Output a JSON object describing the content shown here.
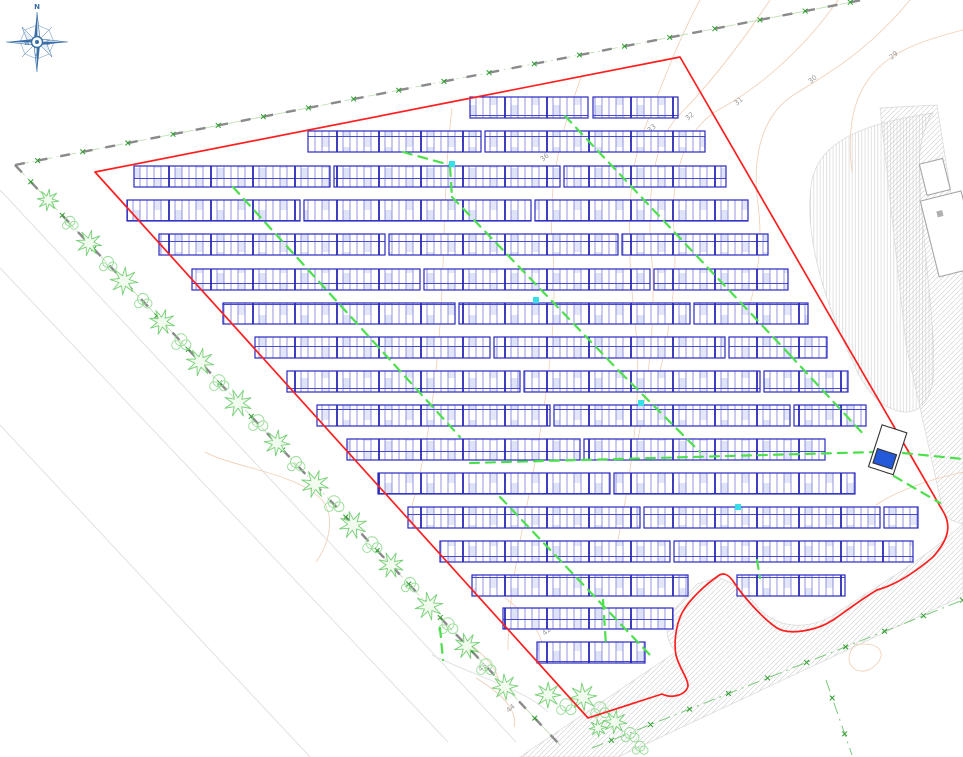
{
  "compass": {
    "n": "N",
    "s": "S",
    "e": "E",
    "w": "W"
  },
  "colors": {
    "boundary_red": "#ff1f1f",
    "panel_blue": "#2a2ac2",
    "panel_grid": "#6a6ad8",
    "panel_fill": "#dfe3f8",
    "cable_green": "#4ce04c",
    "fence_x_green": "#2f9e2f",
    "fence_gray": "#8a8a8a",
    "tree_green": "#76cf76",
    "contour_tan": "#f0cdb2",
    "label_gray": "#9a9a9a",
    "hatch_gray": "#c8c8c8",
    "marker_cyan": "#35e0e8",
    "transformer_blue": "#2459d9",
    "compass_blue": "#3a6ea5"
  },
  "plan": {
    "boundary_path": "M95,172 L680,57 L944,513 C951,526 949,539 933,557 C913,574 895,585 877,590 C860,600 845,612 833,620 C818,630 790,636 777,628 C762,618 742,595 733,581 C728,574 723,572 718,576 C708,583 690,598 682,613 C675,627 674,645 676,655 C679,668 688,678 688,686 C686,695 672,699 662,694 L588,718 Z",
    "panel_row_height": 21,
    "panel_rows": [
      {
        "y": 97,
        "segments": [
          [
            470,
            588
          ],
          [
            593,
            678
          ]
        ]
      },
      {
        "y": 131,
        "segments": [
          [
            308,
            481
          ],
          [
            485,
            705
          ]
        ]
      },
      {
        "y": 166,
        "segments": [
          [
            134,
            330
          ],
          [
            334,
            560
          ],
          [
            564,
            726
          ]
        ]
      },
      {
        "y": 200,
        "segments": [
          [
            127,
            300
          ],
          [
            304,
            531
          ],
          [
            535,
            748
          ]
        ]
      },
      {
        "y": 234,
        "segments": [
          [
            159,
            385
          ],
          [
            389,
            618
          ],
          [
            622,
            768
          ]
        ]
      },
      {
        "y": 269,
        "segments": [
          [
            192,
            420
          ],
          [
            424,
            650
          ],
          [
            654,
            788
          ]
        ]
      },
      {
        "y": 303,
        "segments": [
          [
            223,
            455
          ],
          [
            459,
            690
          ],
          [
            694,
            808
          ]
        ]
      },
      {
        "y": 337,
        "segments": [
          [
            255,
            490
          ],
          [
            494,
            725
          ],
          [
            729,
            827
          ]
        ]
      },
      {
        "y": 371,
        "segments": [
          [
            287,
            520
          ],
          [
            524,
            760
          ],
          [
            764,
            848
          ]
        ]
      },
      {
        "y": 405,
        "segments": [
          [
            317,
            550
          ],
          [
            554,
            790
          ],
          [
            794,
            866
          ]
        ]
      },
      {
        "y": 439,
        "segments": [
          [
            347,
            580
          ],
          [
            584,
            825
          ]
        ]
      },
      {
        "y": 473,
        "segments": [
          [
            378,
            610
          ],
          [
            614,
            855
          ]
        ]
      },
      {
        "y": 507,
        "segments": [
          [
            408,
            640
          ],
          [
            644,
            880
          ],
          [
            884,
            918
          ]
        ]
      },
      {
        "y": 541,
        "segments": [
          [
            440,
            670
          ],
          [
            674,
            913
          ]
        ]
      },
      {
        "y": 575,
        "segments": [
          [
            472,
            688
          ],
          [
            737,
            845
          ]
        ]
      },
      {
        "y": 608,
        "segments": [
          [
            503,
            673
          ]
        ]
      },
      {
        "y": 642,
        "segments": [
          [
            537,
            645
          ]
        ]
      }
    ],
    "cables": [
      [
        233,
        187,
        460,
        437
      ],
      [
        403,
        152,
        450,
        165
      ],
      [
        450,
        167,
        452,
        197
      ],
      [
        452,
        197,
        620,
        372
      ],
      [
        620,
        372,
        700,
        452
      ],
      [
        565,
        116,
        790,
        355
      ],
      [
        790,
        355,
        866,
        437
      ],
      [
        500,
        497,
        650,
        655
      ],
      [
        470,
        463,
        876,
        452
      ],
      [
        903,
        453,
        963,
        459
      ],
      [
        880,
        468,
        940,
        503
      ],
      [
        603,
        600,
        606,
        645
      ],
      [
        440,
        628,
        443,
        660
      ],
      [
        757,
        560,
        760,
        578
      ]
    ],
    "cable_markers": [
      [
        452,
        164
      ],
      [
        536,
        300
      ],
      [
        641,
        403
      ],
      [
        738,
        507
      ]
    ],
    "fences": [
      {
        "x1": 15,
        "y1": 165,
        "x2": 862,
        "y2": 0,
        "step": 46,
        "style": "gray"
      },
      {
        "x1": 15,
        "y1": 165,
        "x2": 560,
        "y2": 745,
        "step": 46,
        "style": "gray"
      },
      {
        "x1": 592,
        "y1": 748,
        "x2": 963,
        "y2": 600,
        "step": 42,
        "style": "green"
      },
      {
        "x1": 826,
        "y1": 680,
        "x2": 852,
        "y2": 755,
        "step": 38,
        "style": "green"
      }
    ],
    "curbs": [
      "M0,190 L516,742",
      "M0,268 L448,742",
      "M0,425 L310,757",
      "M432,655 C480,678 525,690 548,712"
    ],
    "roads": [
      {
        "name": "verge-blob",
        "hatch": "vertical",
        "path": "M933,113 C858,124 820,143 812,180 C803,230 822,296 852,360 C868,398 886,410 904,412 C920,413 930,400 933,380 C938,330 916,205 920,152 C921,137 927,121 933,113 Z"
      },
      {
        "name": "road-east",
        "hatch": "diag",
        "path": "M880,108 L937,105 L963,270 L963,524 C950,521 946,517 943,511 L906,345 Z"
      },
      {
        "name": "road-south",
        "hatch": "diag",
        "path": "M963,524 L963,596 L618,757 L520,757 L676,652 C666,642 664,626 672,612 L697,584 L718,577 L742,588 L760,610 C782,630 812,630 838,612 L900,572 C925,556 945,540 963,524 Z"
      }
    ],
    "contours": [
      "M963,30 C915,42 885,55 868,80 C850,105 848,140 852,172",
      "M910,0 C865,55 820,78 792,96 C760,118 752,160 758,205 C763,240 758,280 748,310",
      "M838,0 C800,55 752,92 718,110 C684,130 670,178 674,232 C678,275 670,330 658,380",
      "M770,0 C738,48 706,88 680,114 C652,142 646,200 652,262 C656,318 648,390 636,450",
      "M700,0 C678,40 660,90 644,130 C624,182 628,262 636,332 C642,395 632,470 618,540",
      "M582,75 C562,128 548,180 552,242 C560,322 544,420 524,520 C515,565 508,610 508,650",
      "M452,108 C442,190 446,280 436,370 C430,430 420,480 408,520",
      "M963,472 C928,480 898,490 876,505",
      "M205,452 C235,468 292,472 320,498 C336,514 330,542 316,562",
      "M505,598 C532,618 548,640 542,662",
      "M462,638 C492,660 504,676 498,697",
      "M476,678 C502,694 518,710 514,727",
      "M855,645 C880,640 890,655 872,668 C856,678 840,662 855,645"
    ],
    "contour_labels": [
      {
        "text": "29",
        "x": 895,
        "y": 57,
        "rot": -40
      },
      {
        "text": "30",
        "x": 814,
        "y": 81,
        "rot": -40
      },
      {
        "text": "31",
        "x": 740,
        "y": 103,
        "rot": -40
      },
      {
        "text": "32",
        "x": 691,
        "y": 118,
        "rot": -40
      },
      {
        "text": "33",
        "x": 653,
        "y": 130,
        "rot": -40
      },
      {
        "text": "36",
        "x": 546,
        "y": 159,
        "rot": -40
      },
      {
        "text": "42",
        "x": 548,
        "y": 633,
        "rot": -40
      },
      {
        "text": "43",
        "x": 484,
        "y": 669,
        "rot": -40
      },
      {
        "text": "44",
        "x": 512,
        "y": 710,
        "rot": -40
      }
    ],
    "trees": [
      {
        "x": 48,
        "y": 200,
        "r": 11,
        "t": "s"
      },
      {
        "x": 70,
        "y": 223,
        "r": 9,
        "t": "r"
      },
      {
        "x": 89,
        "y": 243,
        "r": 13,
        "t": "s"
      },
      {
        "x": 108,
        "y": 264,
        "r": 10,
        "t": "r"
      },
      {
        "x": 124,
        "y": 281,
        "r": 14,
        "t": "s"
      },
      {
        "x": 143,
        "y": 301,
        "r": 10,
        "t": "r"
      },
      {
        "x": 162,
        "y": 322,
        "r": 13,
        "t": "s"
      },
      {
        "x": 181,
        "y": 342,
        "r": 11,
        "t": "r"
      },
      {
        "x": 200,
        "y": 362,
        "r": 14,
        "t": "s"
      },
      {
        "x": 219,
        "y": 383,
        "r": 11,
        "t": "r"
      },
      {
        "x": 238,
        "y": 403,
        "r": 14,
        "t": "s"
      },
      {
        "x": 258,
        "y": 423,
        "r": 11,
        "t": "r"
      },
      {
        "x": 277,
        "y": 443,
        "r": 13,
        "t": "s"
      },
      {
        "x": 296,
        "y": 464,
        "r": 10,
        "t": "r"
      },
      {
        "x": 315,
        "y": 484,
        "r": 14,
        "t": "s"
      },
      {
        "x": 334,
        "y": 504,
        "r": 11,
        "t": "r"
      },
      {
        "x": 353,
        "y": 525,
        "r": 14,
        "t": "s"
      },
      {
        "x": 372,
        "y": 545,
        "r": 11,
        "t": "r"
      },
      {
        "x": 391,
        "y": 565,
        "r": 13,
        "t": "s"
      },
      {
        "x": 410,
        "y": 585,
        "r": 10,
        "t": "r"
      },
      {
        "x": 429,
        "y": 606,
        "r": 14,
        "t": "s"
      },
      {
        "x": 448,
        "y": 626,
        "r": 11,
        "t": "r"
      },
      {
        "x": 467,
        "y": 646,
        "r": 13,
        "t": "s"
      },
      {
        "x": 486,
        "y": 667,
        "r": 11,
        "t": "r"
      },
      {
        "x": 505,
        "y": 687,
        "r": 13,
        "t": "s"
      },
      {
        "x": 548,
        "y": 695,
        "r": 13,
        "t": "s"
      },
      {
        "x": 566,
        "y": 707,
        "r": 11,
        "t": "r"
      },
      {
        "x": 583,
        "y": 697,
        "r": 14,
        "t": "s"
      },
      {
        "x": 600,
        "y": 710,
        "r": 11,
        "t": "r"
      },
      {
        "x": 615,
        "y": 722,
        "r": 12,
        "t": "s"
      },
      {
        "x": 630,
        "y": 735,
        "r": 10,
        "t": "r"
      },
      {
        "x": 598,
        "y": 728,
        "r": 9,
        "t": "s"
      },
      {
        "x": 640,
        "y": 748,
        "r": 9,
        "t": "r"
      }
    ],
    "structures": [
      {
        "name": "transformer-station",
        "rot": 18,
        "cx": 888,
        "cy": 452,
        "rects": [
          {
            "x": 874,
            "y": 428,
            "w": 26,
            "h": 44,
            "fill": "#ffffff",
            "stroke": "#333333"
          },
          {
            "x": 877,
            "y": 452,
            "w": 20,
            "h": 15,
            "fill": "#2459d9",
            "stroke": "#333333"
          }
        ]
      },
      {
        "name": "neighbor-building",
        "rot": -14,
        "cx": 945,
        "cy": 230,
        "rects": [
          {
            "x": 928,
            "y": 196,
            "w": 42,
            "h": 78,
            "fill": "#ffffff",
            "stroke": "#a8a8a8"
          },
          {
            "x": 936,
            "y": 160,
            "w": 24,
            "h": 32,
            "fill": "#ffffff",
            "stroke": "#a8a8a8"
          },
          {
            "x": 941,
            "y": 210,
            "w": 6,
            "h": 6,
            "fill": "#b0b0b0",
            "stroke": "none"
          }
        ]
      }
    ]
  }
}
